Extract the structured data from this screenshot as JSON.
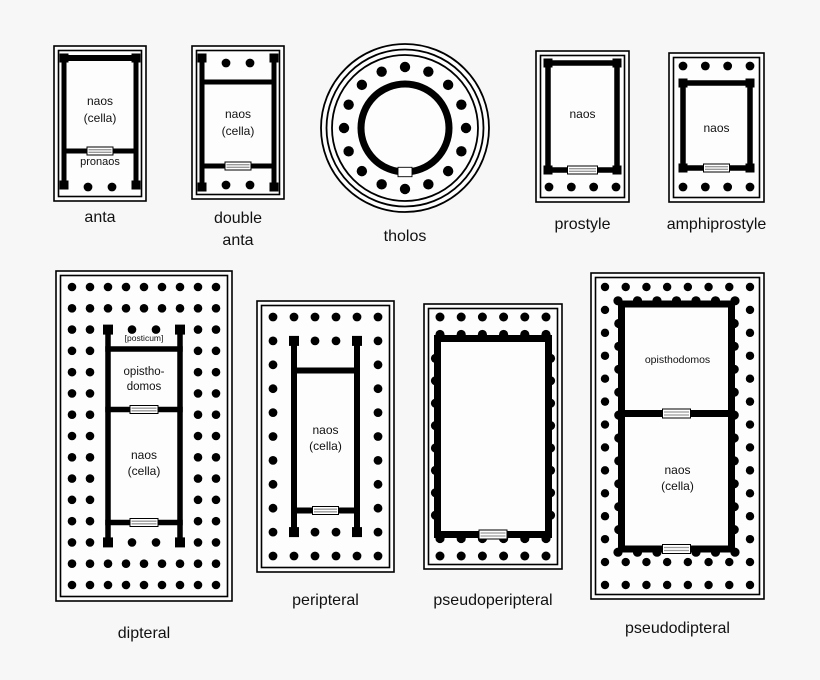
{
  "colors": {
    "background": "#f7f7f7",
    "interior": "#fdfdfd",
    "ink": "#000000",
    "door_stripe": "#9a9a9a"
  },
  "plans": {
    "anta": {
      "caption": "anta",
      "labels": {
        "naos": "naos",
        "cella": "(cella)",
        "pronaos": "pronaos"
      },
      "structure": {
        "pronaos_columns": 2
      }
    },
    "double_anta": {
      "caption_line1": "double",
      "caption_line2": "anta",
      "labels": {
        "naos": "naos",
        "cella": "(cella)"
      },
      "structure": {
        "front_porch_columns": 2,
        "rear_porch_columns": 2
      }
    },
    "tholos": {
      "caption": "tholos",
      "structure": {
        "peristyle_columns": 16
      }
    },
    "prostyle": {
      "caption": "prostyle",
      "labels": {
        "naos": "naos"
      },
      "structure": {
        "porch_columns": 4
      }
    },
    "amphiprostyle": {
      "caption": "amphiprostyle",
      "labels": {
        "naos": "naos"
      },
      "structure": {
        "front_porch_columns": 4,
        "rear_porch_columns": 4
      }
    },
    "dipteral": {
      "caption": "dipteral",
      "labels": {
        "posticum": "[posticum]",
        "opisthodomos_line1": "opistho-",
        "opisthodomos_line2": "domos",
        "naos": "naos",
        "cella": "(cella)"
      },
      "structure": {
        "facade_columns": 9,
        "flank_columns": 15,
        "peristyle_rows": 2,
        "porch_columns": 2
      }
    },
    "peripteral": {
      "caption": "peripteral",
      "labels": {
        "naos": "naos",
        "cella": "(cella)"
      },
      "structure": {
        "facade_columns": 6,
        "flank_columns": 11,
        "peristyle_rows": 1,
        "porch_columns": 2
      }
    },
    "pseudoperipteral": {
      "caption": "pseudoperipteral",
      "structure": {
        "facade_columns": 6,
        "engaged_flank_columns": 8
      }
    },
    "pseudodipteral": {
      "caption": "pseudodipteral",
      "labels": {
        "opisthodomos": "opisthodomos",
        "naos": "naos",
        "cella": "(cella)"
      },
      "structure": {
        "facade_columns": 8,
        "flank_columns": 14,
        "extra_front_row_columns": 8
      }
    }
  }
}
